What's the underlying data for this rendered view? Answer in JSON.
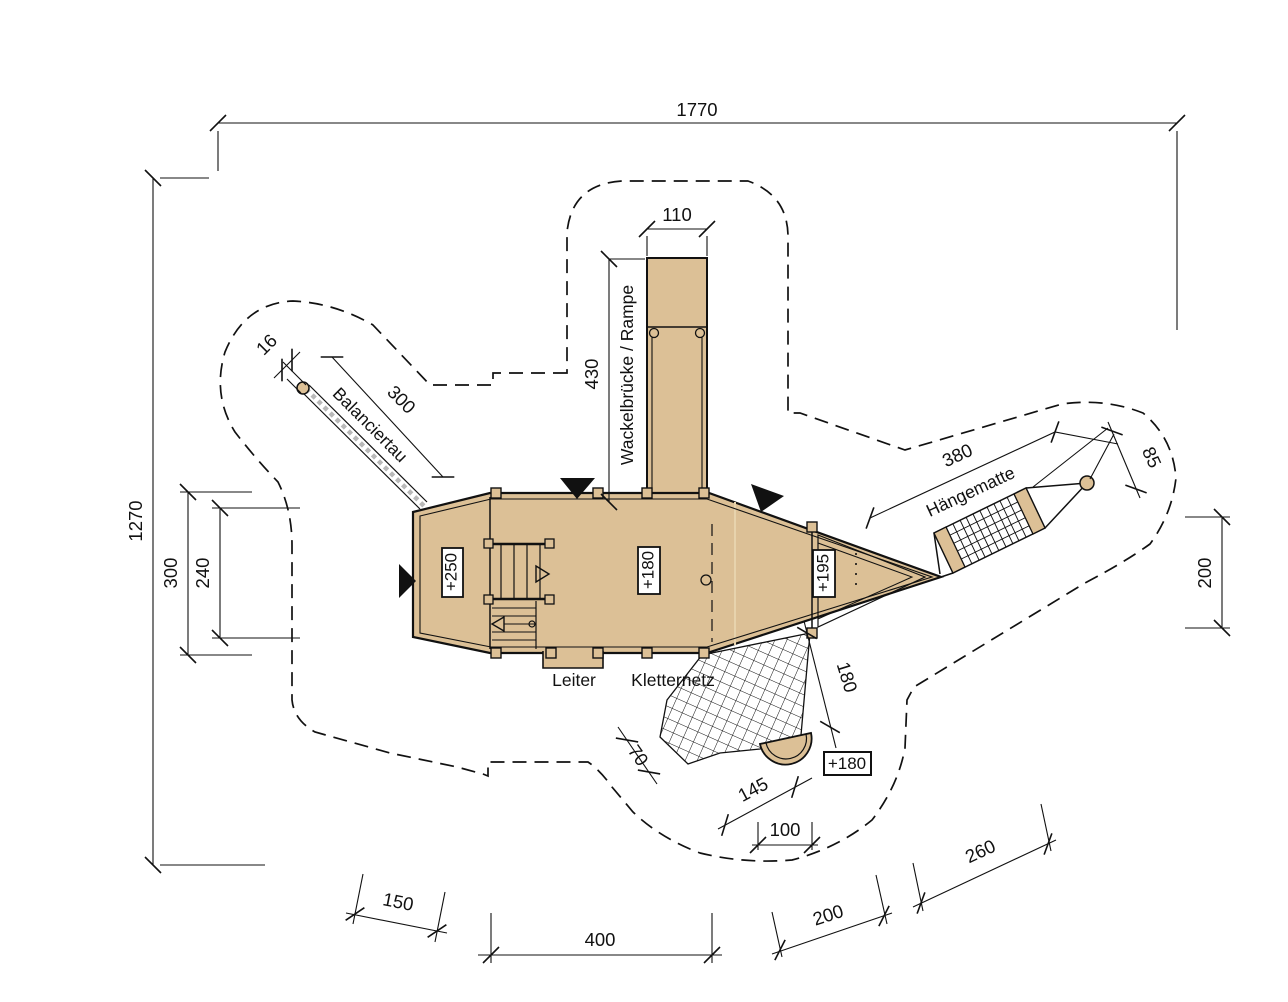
{
  "drawing": {
    "colors": {
      "wood": "#dcc096",
      "outline": "#111111",
      "rope_hatch": "#b9b9b9",
      "background": "#ffffff"
    },
    "labels": {
      "balance_rope": "Balanciertau",
      "bridge": "Wackelbrücke / Rampe",
      "ladder": "Leiter",
      "climbing_net": "Kletternetz",
      "hammock": "Hängematte"
    },
    "elevations": {
      "tower": "+250",
      "main_deck": "+180",
      "bow": "+195",
      "net_platform": "+180"
    },
    "dimensions": {
      "overall_width": "1770",
      "overall_depth": "1270",
      "bridge_width": "110",
      "bridge_length": "430",
      "rope_length": "300",
      "rope_diameter": "16",
      "tower_depth_outer": "300",
      "tower_depth_inner": "240",
      "hammock_length": "380",
      "hammock_offset": "85",
      "right_clearance": "200",
      "net_length": "180",
      "net_width": "70",
      "net_span": "145",
      "platform_width": "100",
      "bottom_left_offset": "150",
      "deck_length": "400",
      "bottom_right_offset_1": "200",
      "bottom_right_offset_2": "260"
    }
  }
}
